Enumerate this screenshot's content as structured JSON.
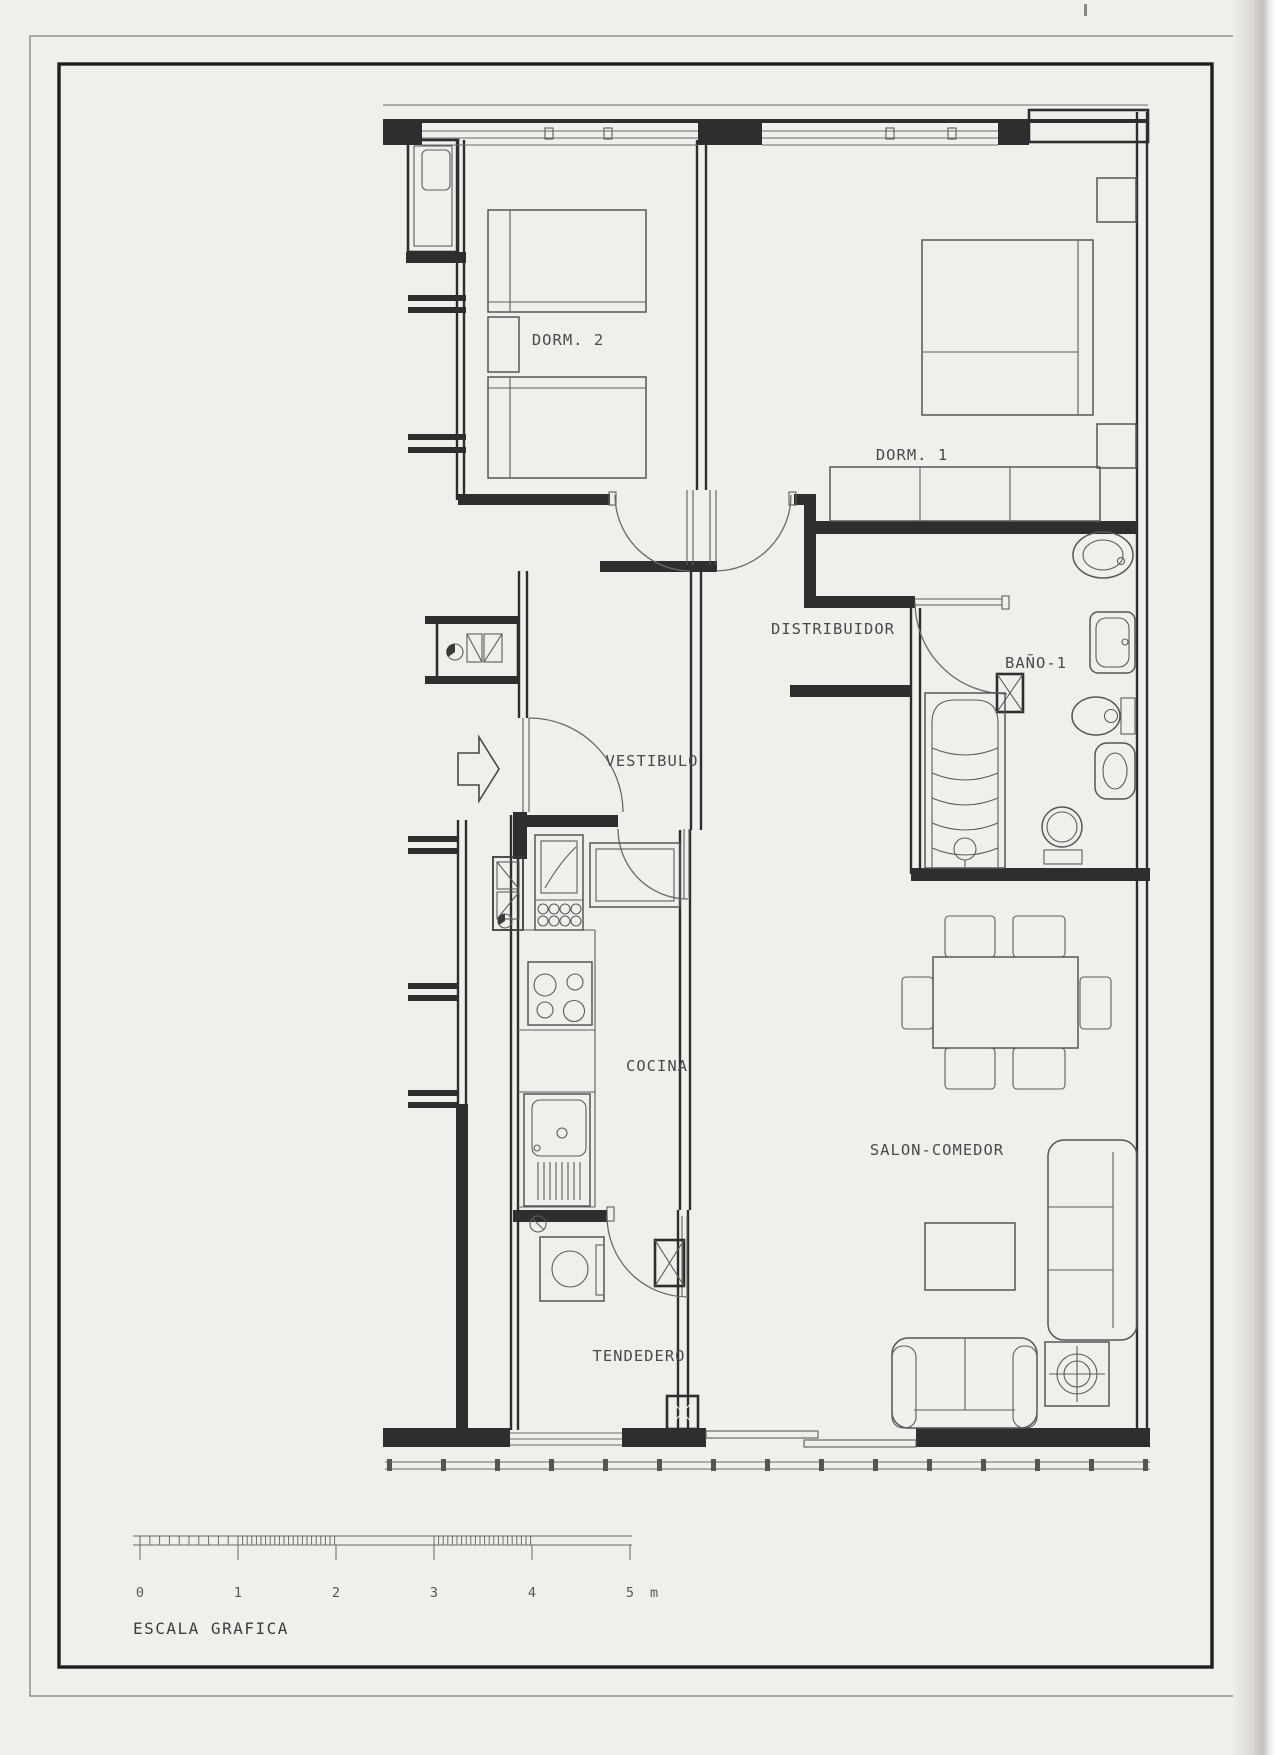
{
  "drawing": {
    "rooms": [
      {
        "id": "dorm2",
        "label": "DORM. 2"
      },
      {
        "id": "dorm1",
        "label": "DORM. 1"
      },
      {
        "id": "distribuidor",
        "label": "DISTRIBUIDOR"
      },
      {
        "id": "bano1",
        "label": "BAÑO-1"
      },
      {
        "id": "vestibulo",
        "label": "VESTIBULO"
      },
      {
        "id": "cocina",
        "label": "COCINA"
      },
      {
        "id": "salon",
        "label": "SALON-COMEDOR"
      },
      {
        "id": "tendedero",
        "label": "TENDEDERO"
      }
    ],
    "scale": {
      "title": "ESCALA GRAFICA",
      "ticks": [
        "0",
        "1",
        "2",
        "3",
        "4",
        "5"
      ],
      "unit": "m"
    },
    "colors": {
      "paper": "#f0efec",
      "wall_ink": "#2e2e2e",
      "line_ink": "#5c5c5c",
      "label_ink": "#4a4a4a"
    }
  }
}
